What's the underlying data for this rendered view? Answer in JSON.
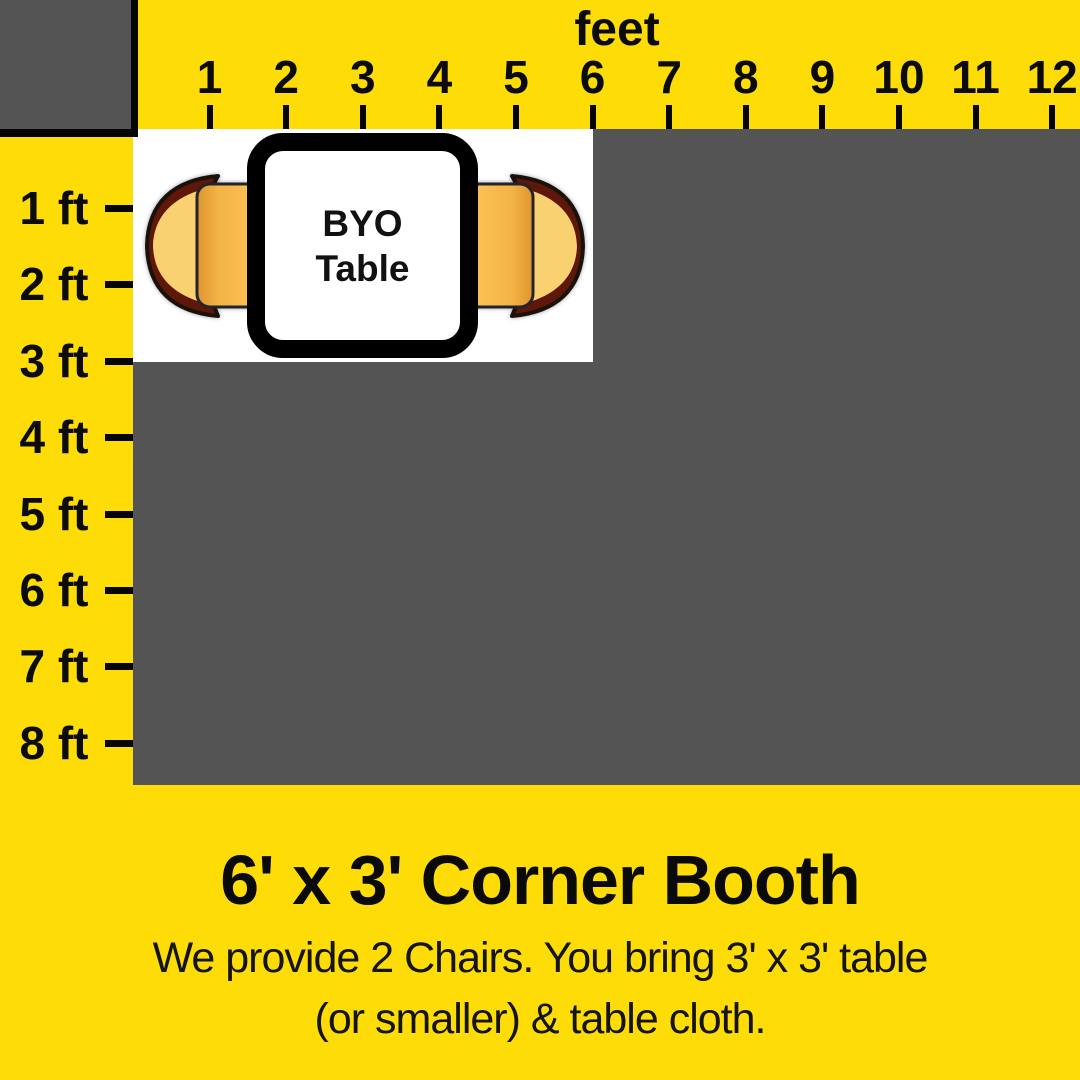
{
  "ruler": {
    "unit_label": "feet",
    "top_ticks": [
      "1",
      "2",
      "3",
      "4",
      "5",
      "6",
      "7",
      "8",
      "9",
      "10",
      "11",
      "12"
    ],
    "left_ticks": [
      "1 ft",
      "2 ft",
      "3 ft",
      "4 ft",
      "5 ft",
      "6 ft",
      "7 ft",
      "8 ft"
    ]
  },
  "booth": {
    "table_label": {
      "line1": "BYO",
      "line2": "Table"
    }
  },
  "caption": {
    "title": "6' x 3' Corner Booth",
    "subtitle_line1": "We provide 2 Chairs. You bring 3' x 3' table",
    "subtitle_line2": "(or smaller) & table cloth."
  },
  "colors": {
    "background_yellow": "#FDDC08",
    "grid_gray": "#545454",
    "booth_white": "#FFFFFF",
    "ink_black": "#0A0A0A",
    "chair_seat": "#FCC155",
    "chair_back_cushion": "#FAD171",
    "chair_back_trim": "#5E1708"
  }
}
